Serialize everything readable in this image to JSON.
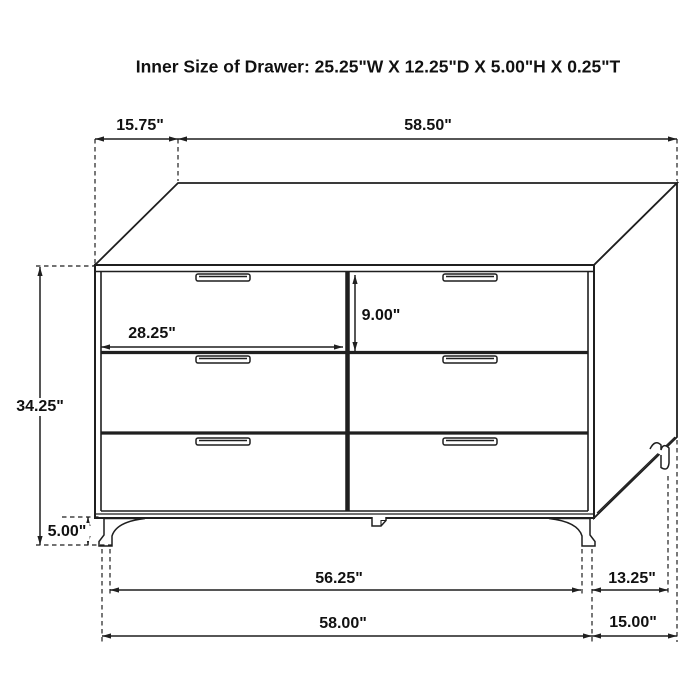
{
  "figure": {
    "title": "Inner Size of Drawer: 25.25\"W X 12.25\"D X 5.00\"H X 0.25\"T",
    "subject": "six-drawer dresser dimension diagram"
  },
  "dimensions": {
    "top_depth_left": "15.75\"",
    "top_width": "58.50\"",
    "overall_height": "34.25\"",
    "leg_height": "5.00\"",
    "drawer_front_width": "28.25\"",
    "drawer_front_height": "9.00\"",
    "base_inner_width": "56.25\"",
    "base_side_depth": "13.25\"",
    "base_overall_width": "58.00\"",
    "base_overall_depth": "15.00\""
  },
  "colors": {
    "line": "#1f1f1f",
    "background": "#ffffff"
  }
}
